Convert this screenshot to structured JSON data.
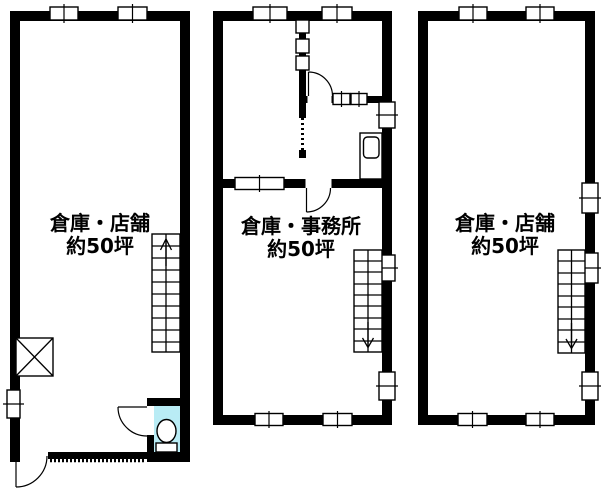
{
  "plan": {
    "units": [
      {
        "id": "left",
        "name": "倉庫・店舗",
        "area": "約50坪"
      },
      {
        "id": "middle",
        "name": "倉庫・事務所",
        "area": "約50坪"
      },
      {
        "id": "right",
        "name": "倉庫・店舗",
        "area": "約50坪"
      }
    ],
    "colors": {
      "wall": "#000000",
      "line": "#000000",
      "background": "#ffffff",
      "toilet_floor": "#b9ecf5"
    }
  }
}
